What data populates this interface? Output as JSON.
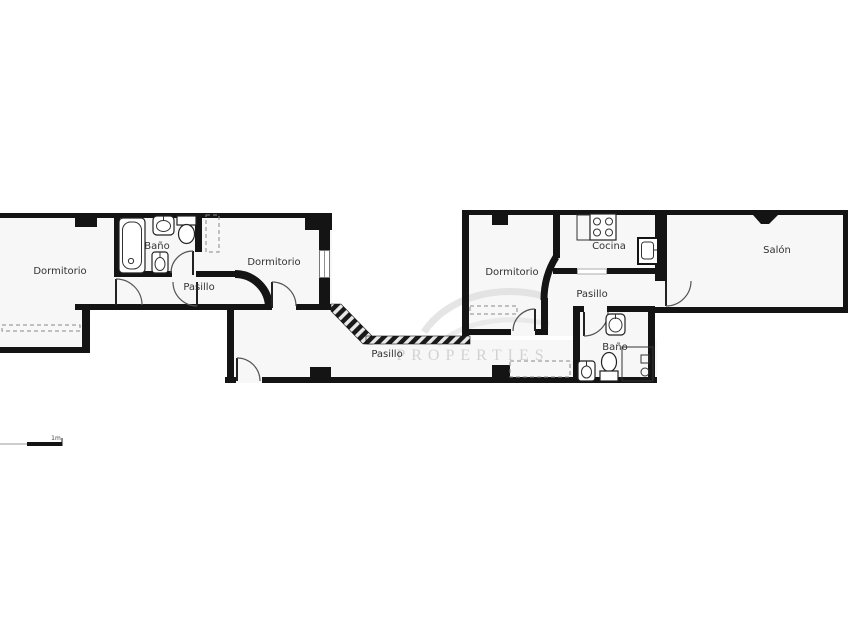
{
  "page": {
    "background": "#ffffff"
  },
  "floorplan": {
    "wall_color": "#141414",
    "room_fill": "#f7f7f7",
    "label_color": "#333333",
    "rooms": [
      {
        "id": "dormitorio-1",
        "label": "Dormitorio"
      },
      {
        "id": "bano-1",
        "label": "Baño"
      },
      {
        "id": "pasillo-1",
        "label": "Pasillo"
      },
      {
        "id": "dormitorio-2",
        "label": "Dormitorio"
      },
      {
        "id": "pasillo-2",
        "label": "Pasillo"
      },
      {
        "id": "dormitorio-3",
        "label": "Dormitorio"
      },
      {
        "id": "cocina",
        "label": "Cocina"
      },
      {
        "id": "pasillo-3",
        "label": "Pasillo"
      },
      {
        "id": "bano-2",
        "label": "Baño"
      },
      {
        "id": "salon",
        "label": "Salón"
      }
    ],
    "fixtures": [
      "bathtub",
      "washbasin-1",
      "toilet-1",
      "bidet-1",
      "stove-hob",
      "kitchen-sink",
      "washbasin-2",
      "toilet-2",
      "shower",
      "bidet-2"
    ],
    "scale_bar": {
      "label": "1m"
    },
    "watermark": {
      "text": "PROPERTIES"
    }
  }
}
